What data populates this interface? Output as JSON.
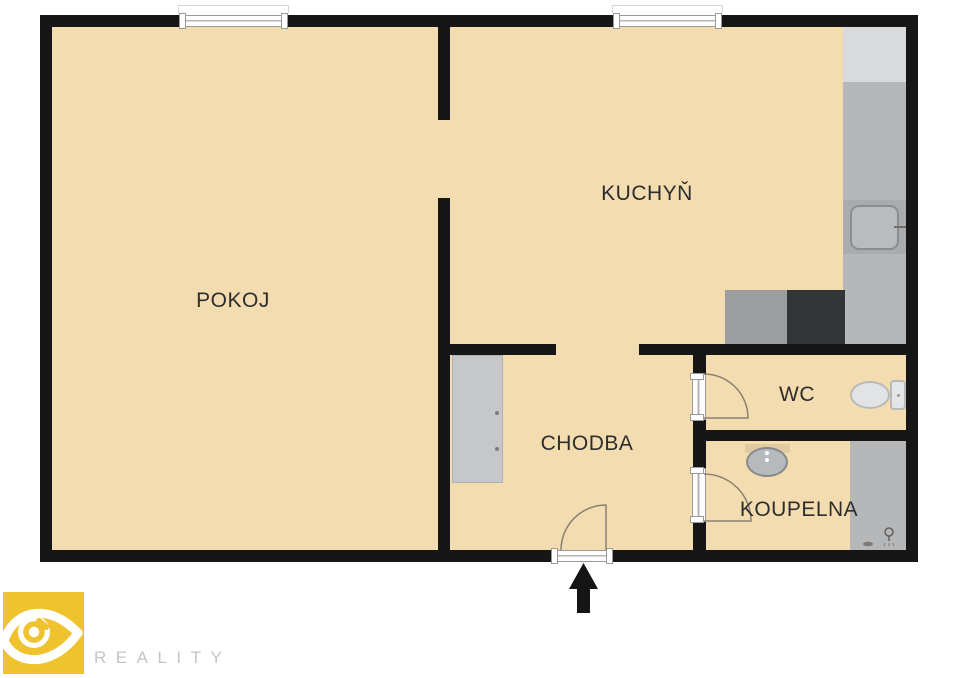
{
  "title": "Floor plan",
  "rooms": {
    "pokoj": {
      "label": "POKOJ"
    },
    "kuchyn": {
      "label": "KUCHYŇ"
    },
    "chodba": {
      "label": "CHODBA"
    },
    "wc": {
      "label": "WC"
    },
    "koupelna": {
      "label": "KOUPELNA"
    }
  },
  "branding": {
    "wordmark": "REALITY",
    "logo_color": "#efc32d",
    "wordmark_color": "#c5c5c5"
  },
  "colors": {
    "floor": "#f3ddb0",
    "wall": "#161616",
    "counter_gray": "#b5b7b9",
    "appliance_light_gray": "#d9dadb",
    "appliance_mid_gray": "#9b9da0",
    "appliance_dark_gray": "#333639",
    "fixture_fill": "#e1e3e4",
    "door_arc": "#8b8072"
  }
}
